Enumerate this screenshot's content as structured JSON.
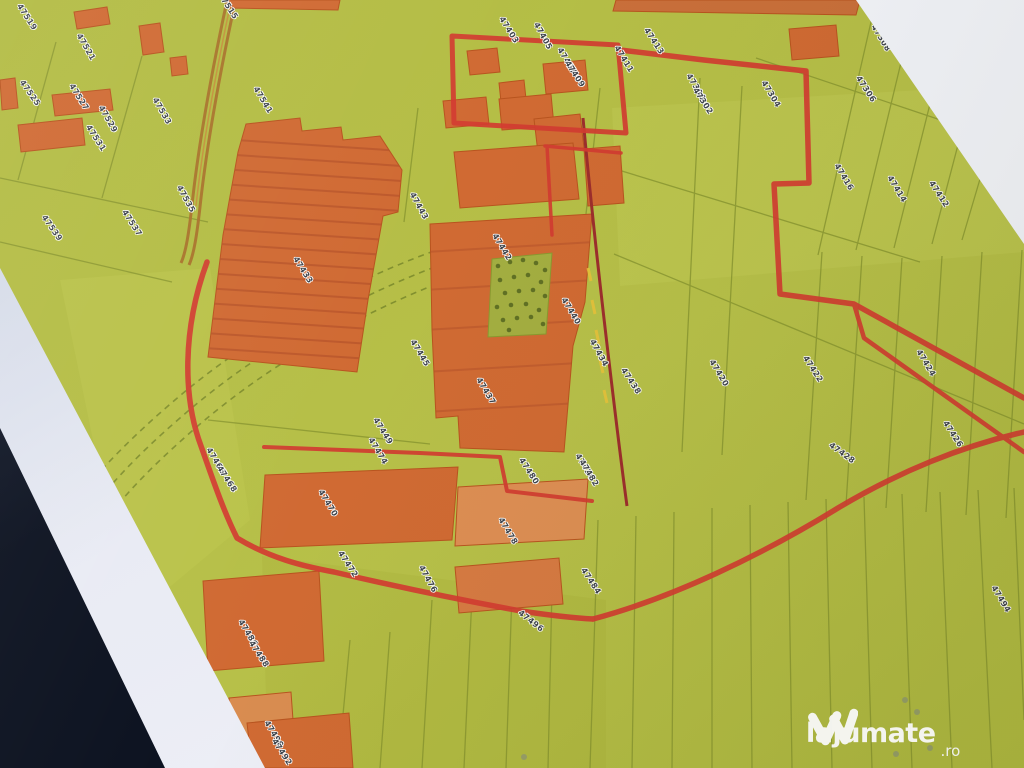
{
  "map": {
    "description_labels_note": "rotated cadastral parcel numbers",
    "labels": [
      {
        "text": "47519",
        "x": 27,
        "y": 17,
        "rot": 57
      },
      {
        "text": "47521",
        "x": 86,
        "y": 47,
        "rot": 60
      },
      {
        "text": "47515",
        "x": 228,
        "y": 6,
        "rot": 57
      },
      {
        "text": "47525",
        "x": 30,
        "y": 93,
        "rot": 55
      },
      {
        "text": "47527",
        "x": 79,
        "y": 97,
        "rot": 58
      },
      {
        "text": "47529",
        "x": 108,
        "y": 119,
        "rot": 60
      },
      {
        "text": "47531",
        "x": 96,
        "y": 138,
        "rot": 57
      },
      {
        "text": "47533",
        "x": 162,
        "y": 111,
        "rot": 60
      },
      {
        "text": "47535",
        "x": 186,
        "y": 199,
        "rot": 61
      },
      {
        "text": "47537",
        "x": 132,
        "y": 223,
        "rot": 57
      },
      {
        "text": "47539",
        "x": 52,
        "y": 228,
        "rot": 55
      },
      {
        "text": "47541",
        "x": 263,
        "y": 100,
        "rot": 59
      },
      {
        "text": "47433",
        "x": 303,
        "y": 270,
        "rot": 58
      },
      {
        "text": "47443",
        "x": 419,
        "y": 206,
        "rot": 61
      },
      {
        "text": "47445",
        "x": 420,
        "y": 353,
        "rot": 59
      },
      {
        "text": "47449",
        "x": 383,
        "y": 431,
        "rot": 58
      },
      {
        "text": "47437",
        "x": 486,
        "y": 391,
        "rot": 59
      },
      {
        "text": "47403",
        "x": 509,
        "y": 30,
        "rot": 58
      },
      {
        "text": "47405",
        "x": 543,
        "y": 36,
        "rot": 61
      },
      {
        "text": "47407",
        "x": 567,
        "y": 61,
        "rot": 59
      },
      {
        "text": "47409",
        "x": 575,
        "y": 74,
        "rot": 57
      },
      {
        "text": "47411",
        "x": 624,
        "y": 59,
        "rot": 59
      },
      {
        "text": "47413",
        "x": 654,
        "y": 41,
        "rot": 57
      },
      {
        "text": "47300",
        "x": 696,
        "y": 87,
        "rot": 59
      },
      {
        "text": "47302",
        "x": 703,
        "y": 101,
        "rot": 57
      },
      {
        "text": "47304",
        "x": 771,
        "y": 94,
        "rot": 59
      },
      {
        "text": "47306",
        "x": 866,
        "y": 89,
        "rot": 57
      },
      {
        "text": "47308",
        "x": 881,
        "y": 38,
        "rot": 59
      },
      {
        "text": "47310",
        "x": 926,
        "y": 49,
        "rot": 57
      },
      {
        "text": "47416",
        "x": 844,
        "y": 177,
        "rot": 59
      },
      {
        "text": "47414",
        "x": 897,
        "y": 189,
        "rot": 59
      },
      {
        "text": "47412",
        "x": 939,
        "y": 194,
        "rot": 57
      },
      {
        "text": "47410",
        "x": 999,
        "y": 199,
        "rot": 59
      },
      {
        "text": "47420",
        "x": 719,
        "y": 373,
        "rot": 59
      },
      {
        "text": "47422",
        "x": 813,
        "y": 369,
        "rot": 57
      },
      {
        "text": "47424",
        "x": 926,
        "y": 363,
        "rot": 59
      },
      {
        "text": "47426",
        "x": 953,
        "y": 434,
        "rot": 57
      },
      {
        "text": "47428",
        "x": 842,
        "y": 453,
        "rot": 36
      },
      {
        "text": "47434",
        "x": 599,
        "y": 353,
        "rot": 61
      },
      {
        "text": "47436",
        "x": 585,
        "y": 467,
        "rot": 59
      },
      {
        "text": "47438",
        "x": 631,
        "y": 381,
        "rot": 57
      },
      {
        "text": "47440",
        "x": 571,
        "y": 311,
        "rot": 59
      },
      {
        "text": "47442",
        "x": 502,
        "y": 247,
        "rot": 59
      },
      {
        "text": "47466",
        "x": 216,
        "y": 461,
        "rot": 59
      },
      {
        "text": "47468",
        "x": 227,
        "y": 479,
        "rot": 57
      },
      {
        "text": "47470",
        "x": 328,
        "y": 503,
        "rot": 59
      },
      {
        "text": "47472",
        "x": 348,
        "y": 564,
        "rot": 57
      },
      {
        "text": "47474",
        "x": 378,
        "y": 451,
        "rot": 59
      },
      {
        "text": "47476",
        "x": 428,
        "y": 579,
        "rot": 61
      },
      {
        "text": "47478",
        "x": 508,
        "y": 531,
        "rot": 59
      },
      {
        "text": "47480",
        "x": 529,
        "y": 471,
        "rot": 57
      },
      {
        "text": "47482",
        "x": 589,
        "y": 473,
        "rot": 59
      },
      {
        "text": "47484",
        "x": 591,
        "y": 581,
        "rot": 57
      },
      {
        "text": "47486",
        "x": 248,
        "y": 633,
        "rot": 59
      },
      {
        "text": "47488",
        "x": 259,
        "y": 654,
        "rot": 57
      },
      {
        "text": "47490",
        "x": 274,
        "y": 734,
        "rot": 59
      },
      {
        "text": "47492",
        "x": 282,
        "y": 752,
        "rot": 57
      },
      {
        "text": "47494",
        "x": 1001,
        "y": 599,
        "rot": 59
      },
      {
        "text": "47496",
        "x": 531,
        "y": 621,
        "rot": 38
      }
    ],
    "colors": {
      "map_green": "#b4bd45",
      "field_line_olive": "#84922e",
      "building_orange": "#d06a33",
      "building_orange_light": "#dd8e53",
      "boundary_red": "#d23c31",
      "road_dark_red": "#9c2e2c",
      "road_brown": "#a9762c",
      "vegetation_green": "#55661f",
      "label_ink": "#3e434b",
      "paper_white": "#eceef6",
      "desk_dark": "#0d1322",
      "watermark_white": "#fafafc"
    }
  },
  "watermark": {
    "brand": "lajumate",
    "tld": ".ro"
  }
}
